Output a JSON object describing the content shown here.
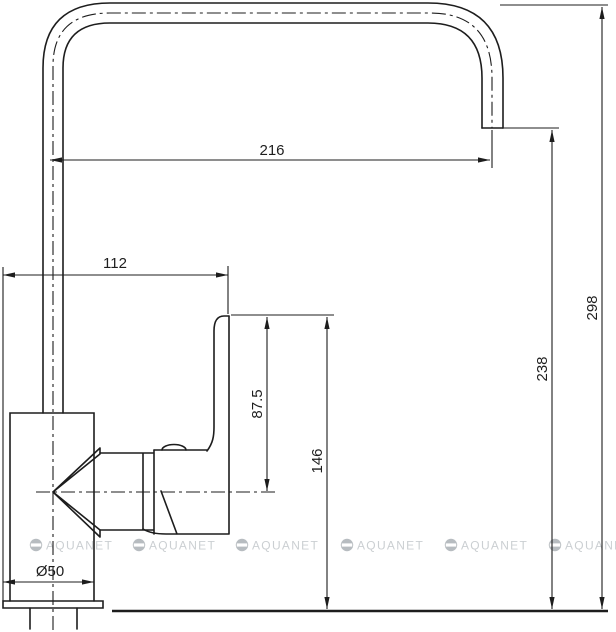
{
  "drawing": {
    "labels": {
      "spout_reach": "216",
      "spout_horizontal_offset": "112",
      "handle_rise_above_center": "87.5",
      "handle_top_height": "146",
      "outlet_height": "238",
      "total_height": "298",
      "base_diameter": "Ø50"
    },
    "watermark": {
      "text": "AQUANET"
    },
    "colors": {
      "line": "#1d1d1d",
      "watermark_text": "#cbcfd2",
      "watermark_logo": "#b7bcc0",
      "background": "#ffffff"
    }
  }
}
